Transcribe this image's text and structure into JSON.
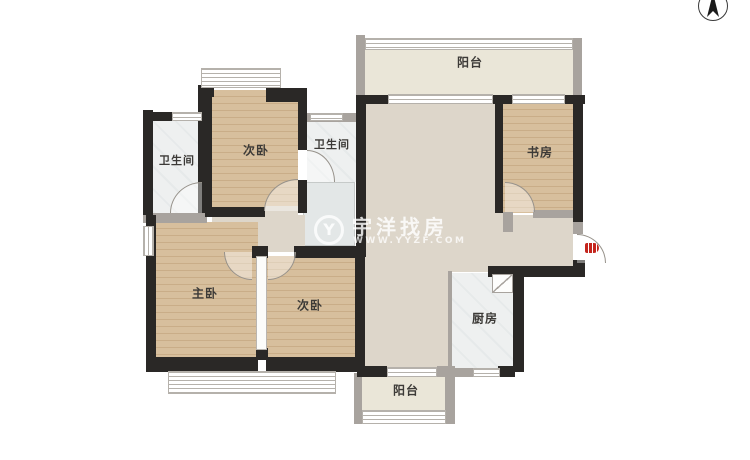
{
  "meta": {
    "type": "apartment-floor-plan"
  },
  "colors": {
    "wall_dark": "#2a2826",
    "wall_gray": "#a8a39e",
    "floor_wood": "#d7bf9d",
    "floor_living": "#ddd6ca",
    "floor_tile": "#eef0f0",
    "floor_balcony": "#eae6d8",
    "entry_door_red": "#c4251d",
    "label_text": "#3c3a37",
    "watermark_white": "#ffffff"
  },
  "rooms": {
    "balcony_top": {
      "label": "阳台"
    },
    "study": {
      "label": "书房"
    },
    "bedroom_top": {
      "label": "次卧"
    },
    "bath_left": {
      "label": "卫生间"
    },
    "bath_mid": {
      "label": "卫生间"
    },
    "master": {
      "label": "主卧"
    },
    "bedroom_mid": {
      "label": "次卧"
    },
    "kitchen": {
      "label": "厨房"
    },
    "balcony_bottom": {
      "label": "阳台"
    }
  },
  "watermark": {
    "logo": "Y",
    "brand": "宇洋找房",
    "url": "WWW.YYZF.COM"
  }
}
